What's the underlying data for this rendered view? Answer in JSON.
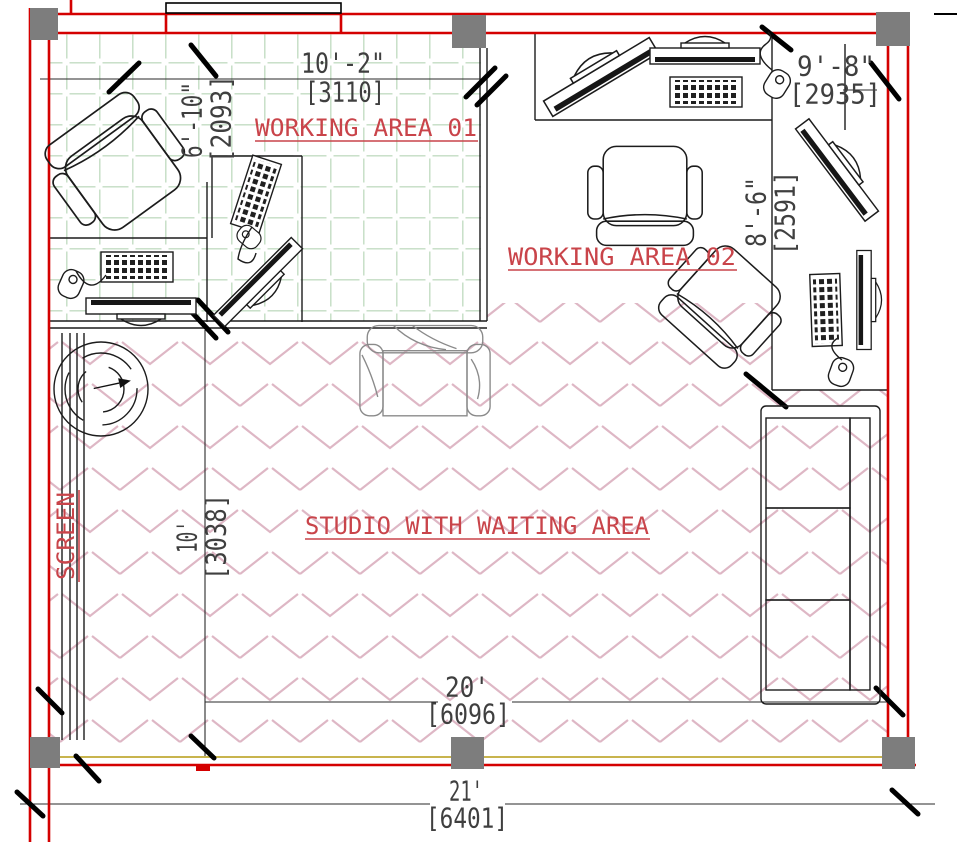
{
  "drawing": {
    "type": "architectural-floor-plan",
    "rooms": [
      "WORKING AREA 01",
      "WORKING AREA 02",
      "STUDIO WITH WAITING AREA"
    ]
  },
  "labels": {
    "working_area_01": "WORKING AREA 01",
    "working_area_02": "WORKING AREA 02",
    "studio_waiting": "STUDIO WITH WAITING AREA",
    "screen": "SCREEN"
  },
  "dims": {
    "w01_w_ft": "10'-2\"",
    "w01_w_mm": "[3110]",
    "w02_w_ft": "9'-8\"",
    "w02_w_mm": "[2935]",
    "w01_h_ft": "6'-10\"",
    "w01_h_mm": "[2093]",
    "w02_h_ft": "8'-6\"",
    "w02_h_mm": "[2591]",
    "studio_h_ft": "10'",
    "studio_h_mm": "[3038]",
    "studio_w_ft": "20'",
    "studio_w_mm": "[6096]",
    "overall_w_ft": "21'",
    "overall_w_mm": "[6401]"
  },
  "colors": {
    "wall_red": "#d40000",
    "column_gray": "#7d7d7d",
    "tile_grid_green": "#c3dcc3",
    "carpet_chevron_pink": "#d8abbb",
    "window_yellow": "#c8b44e",
    "room_label_red": "#c9444a",
    "dim_text_gray": "#3f3f3f"
  }
}
